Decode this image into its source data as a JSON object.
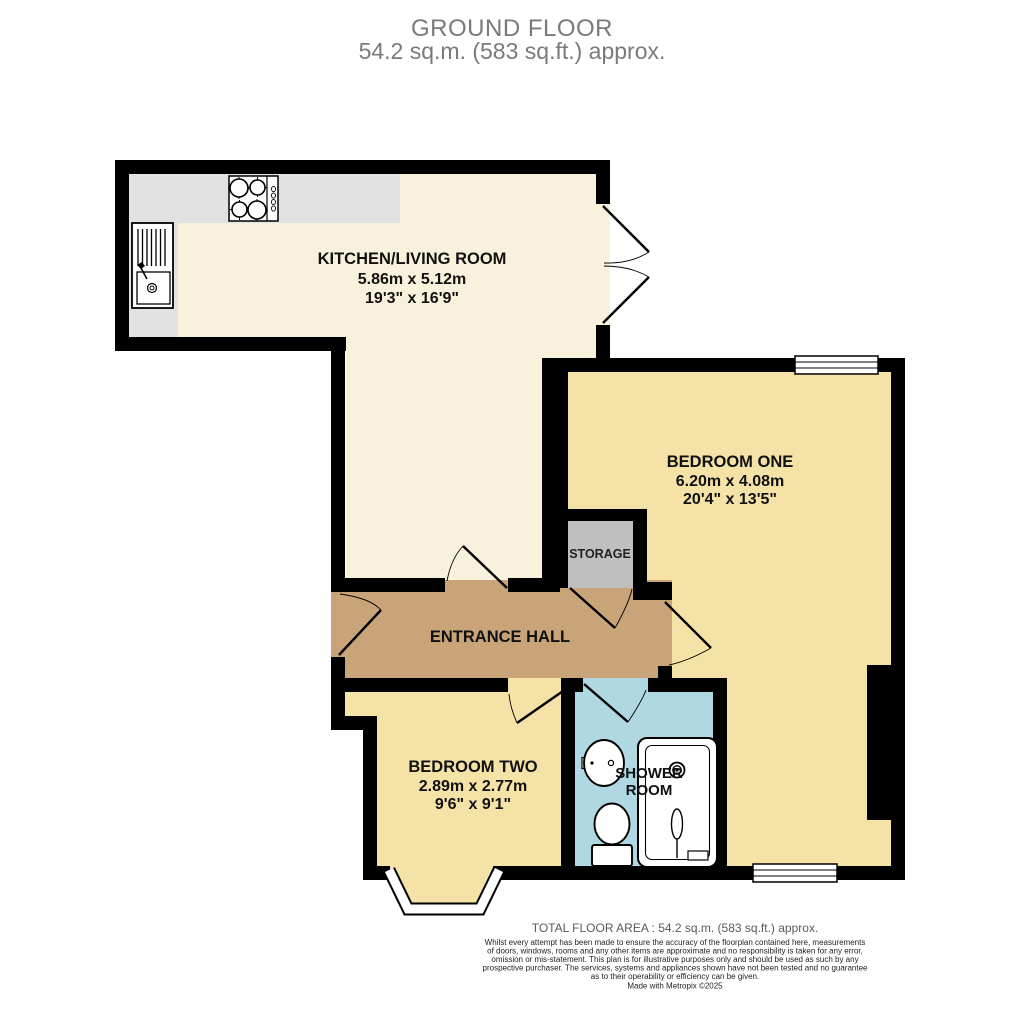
{
  "title": {
    "line1": "GROUND FLOOR",
    "line2": "54.2 sq.m. (583 sq.ft.) approx."
  },
  "rooms": {
    "kitchen_living": {
      "name": "KITCHEN/LIVING ROOM",
      "metric": "5.86m  x 5.12m",
      "imperial": "19'3\"  x 16'9\""
    },
    "bedroom_one": {
      "name": "BEDROOM ONE",
      "metric": "6.20m  x 4.08m",
      "imperial": "20'4\"  x 13'5\""
    },
    "bedroom_two": {
      "name": "BEDROOM TWO",
      "metric": "2.89m  x 2.77m",
      "imperial": "9'6\"  x 9'1\""
    },
    "entrance_hall": {
      "name": "ENTRANCE HALL"
    },
    "shower_room": {
      "name_line1": "SHOWER",
      "name_line2": "ROOM"
    },
    "storage": {
      "name": "STORAGE"
    }
  },
  "footer": {
    "total_area": "TOTAL FLOOR AREA : 54.2 sq.m. (583 sq.ft.) approx.",
    "disclaimer_lines": [
      "Whilst every attempt has been made to ensure the accuracy of the floorplan contained here, measurements",
      "of doors, windows, rooms and any other items are approximate and no responsibility is taken for any error,",
      "omission or mis-statement. This plan is for illustrative purposes only and should be used as such by any",
      "prospective purchaser. The services, systems and appliances shown have not been tested and no guarantee",
      "as to their operability or efficiency can be given."
    ],
    "credit": "Made with Metropix ©2025"
  },
  "colors": {
    "wall": "#000000",
    "kitchen_floor": "#F8F2DC",
    "bedroom_floor": "#F5E2A6",
    "hall_floor": "#C8A478",
    "shower_floor": "#AFD8E3",
    "storage_floor": "#BFBFBF",
    "counter": "#E2E2E2",
    "window_fill": "#FFFFFF",
    "title_text": "#7A7A7A"
  }
}
